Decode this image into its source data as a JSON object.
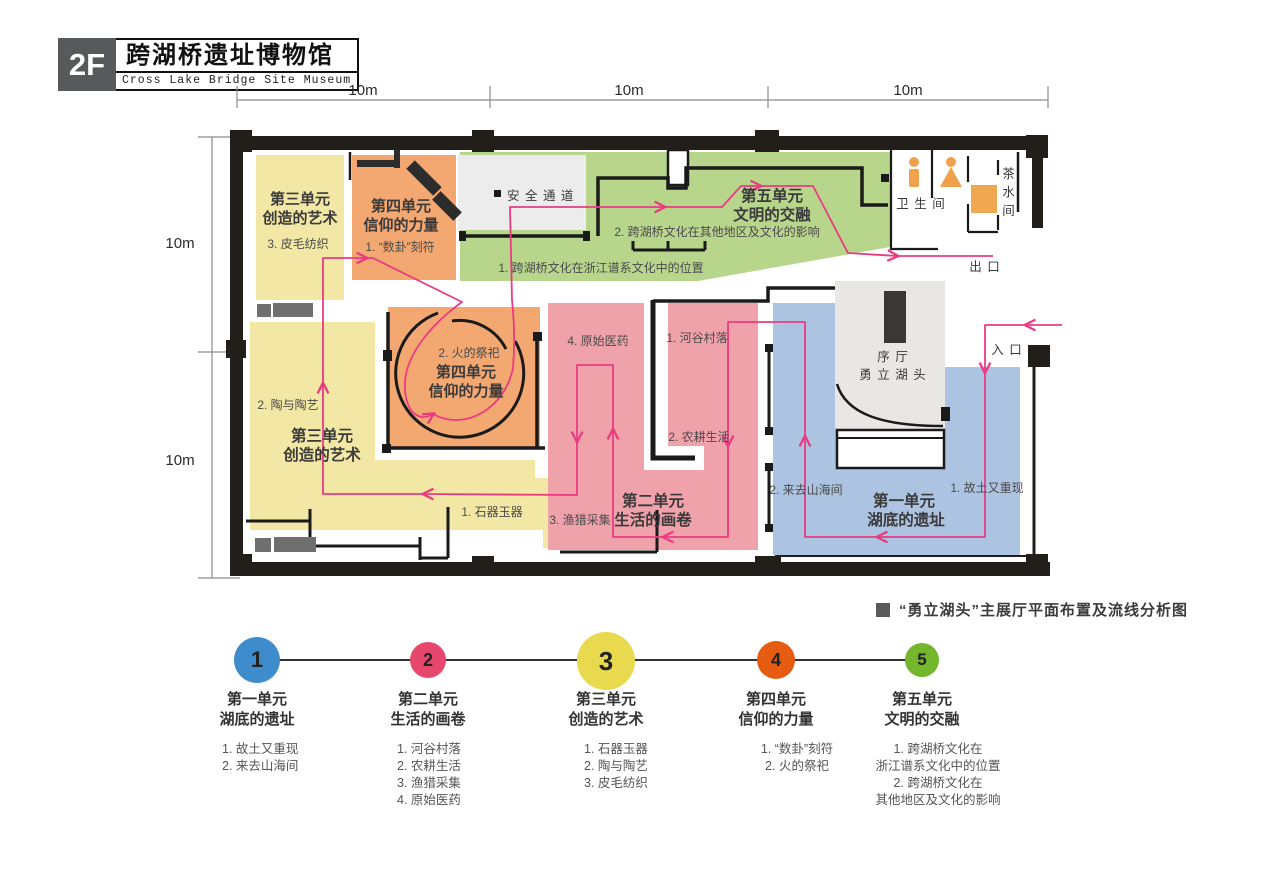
{
  "header": {
    "floor": "2F",
    "title_zh": "跨湖桥遗址博物馆",
    "title_en": "Cross Lake Bridge Site Museum"
  },
  "dimensions": {
    "top": [
      "10m",
      "10m",
      "10m"
    ],
    "left": [
      "10m",
      "10m"
    ]
  },
  "plan": {
    "unit3_top": {
      "line1": "第三单元",
      "line2": "创造的艺术",
      "item": "3. 皮毛纺织"
    },
    "unit4_top": {
      "line1": "第四单元",
      "line2": "信仰的力量",
      "item": "1. “数卦”刻符"
    },
    "safe_passage": "安 全 通 道",
    "unit5": {
      "line1": "第五单元",
      "line2": "文明的交融",
      "item2": "2. 跨湖桥文化在其他地区及文化的影响",
      "item1": "1. 跨湖桥文化在浙江谱系文化中的位置"
    },
    "restroom": "卫 生 间",
    "tea_room": "茶水间",
    "exit": "出 口",
    "entrance": "入 口",
    "unit3_main": {
      "line1": "第三单元",
      "line2": "创造的艺术",
      "item2": "2. 陶与陶艺",
      "item1": "1. 石器玉器"
    },
    "unit4_main": {
      "line1": "第四单元",
      "line2": "信仰的力量",
      "item": "2. 火的祭祀"
    },
    "unit2": {
      "line1": "第二单元",
      "line2": "生活的画卷",
      "item1": "1. 河谷村落",
      "item2": "2. 农耕生活",
      "item3": "3. 渔猎采集",
      "item4": "4. 原始医药"
    },
    "unit1": {
      "line1": "第一单元",
      "line2": "湖底的遗址",
      "item1": "1. 故土又重现",
      "item2": "2. 来去山海间"
    },
    "hall": {
      "line1": "序 厅",
      "line2": "勇 立 湖 头"
    }
  },
  "caption": "“勇立湖头”主展厅平面布置及流线分析图",
  "legend": {
    "units": [
      {
        "num": "1",
        "color": "#3f8ccc",
        "line1": "第一单元",
        "line2": "湖底的遗址",
        "items": [
          "1. 故土又重现",
          "2. 来去山海间"
        ]
      },
      {
        "num": "2",
        "color": "#e8476d",
        "line1": "第二单元",
        "line2": "生活的画卷",
        "items": [
          "1. 河谷村落",
          "2. 农耕生活",
          "3. 渔猎采集",
          "4. 原始医药"
        ]
      },
      {
        "num": "3",
        "color": "#e8d94e",
        "line1": "第三单元",
        "line2": "创造的艺术",
        "items": [
          "1. 石器玉器",
          "2. 陶与陶艺",
          "3. 皮毛纺织"
        ]
      },
      {
        "num": "4",
        "color": "#e65c10",
        "line1": "第四单元",
        "line2": "信仰的力量",
        "items": [
          "1. “数卦”刻符",
          "2. 火的祭祀"
        ]
      },
      {
        "num": "5",
        "color": "#74b62c",
        "line1": "第五单元",
        "line2": "文明的交融",
        "items": [
          "1. 跨湖桥文化在",
          "浙江谱系文化中的位置",
          "2. 跨湖桥文化在",
          "其他地区及文化的影响"
        ]
      }
    ]
  },
  "colors": {
    "zone_yellow": "#f2e7a4",
    "zone_orange": "#f3a771",
    "zone_green": "#b7d68c",
    "zone_pink": "#f0a2ab",
    "zone_blue": "#adc3e2",
    "zone_gray": "#ececec",
    "wall": "#221e1a",
    "flow_line": "#ea3b82",
    "icon_orange": "#efa24b"
  }
}
